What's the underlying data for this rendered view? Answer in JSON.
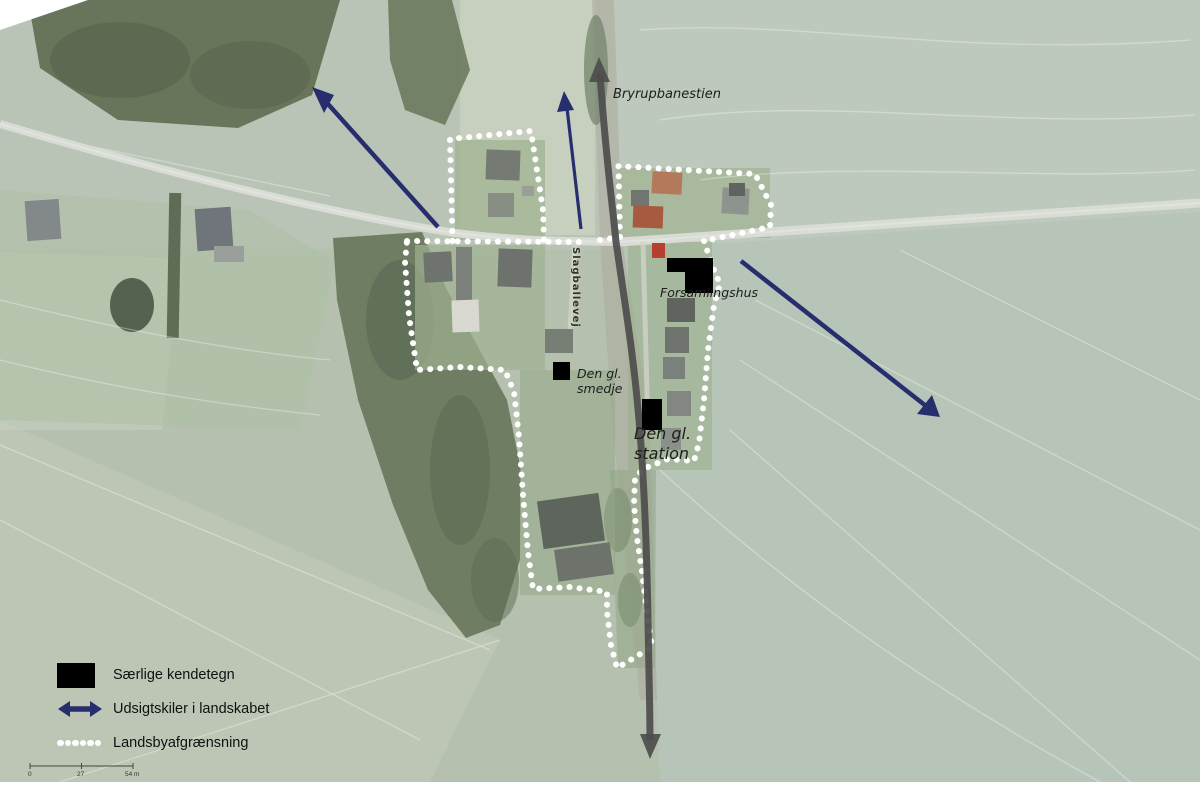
{
  "map": {
    "labels": {
      "trail": "Bryrupbanestien",
      "road": "Slagballevej",
      "community_house": "Forsamlingshus",
      "smithy_line1": "Den gl.",
      "smithy_line2": "smedje",
      "station_line1": "Den gl.",
      "station_line2": "station"
    }
  },
  "legend": {
    "items": [
      {
        "icon": "black-rect",
        "label": "Særlige kendetegn"
      },
      {
        "icon": "double-arrow",
        "label": "Udsigtskiler i landskabet"
      },
      {
        "icon": "dotted-line",
        "label": "Landsbyafgrænsning"
      }
    ]
  },
  "scale_bar": {
    "start": "0",
    "middle": "27",
    "end": "54 m"
  },
  "colors": {
    "view_arrow_navy": "#272e6d",
    "trail_arrow_gray": "#4d4d4d",
    "boundary_dot_white": "#ffffff",
    "feature_black": "#000000"
  }
}
